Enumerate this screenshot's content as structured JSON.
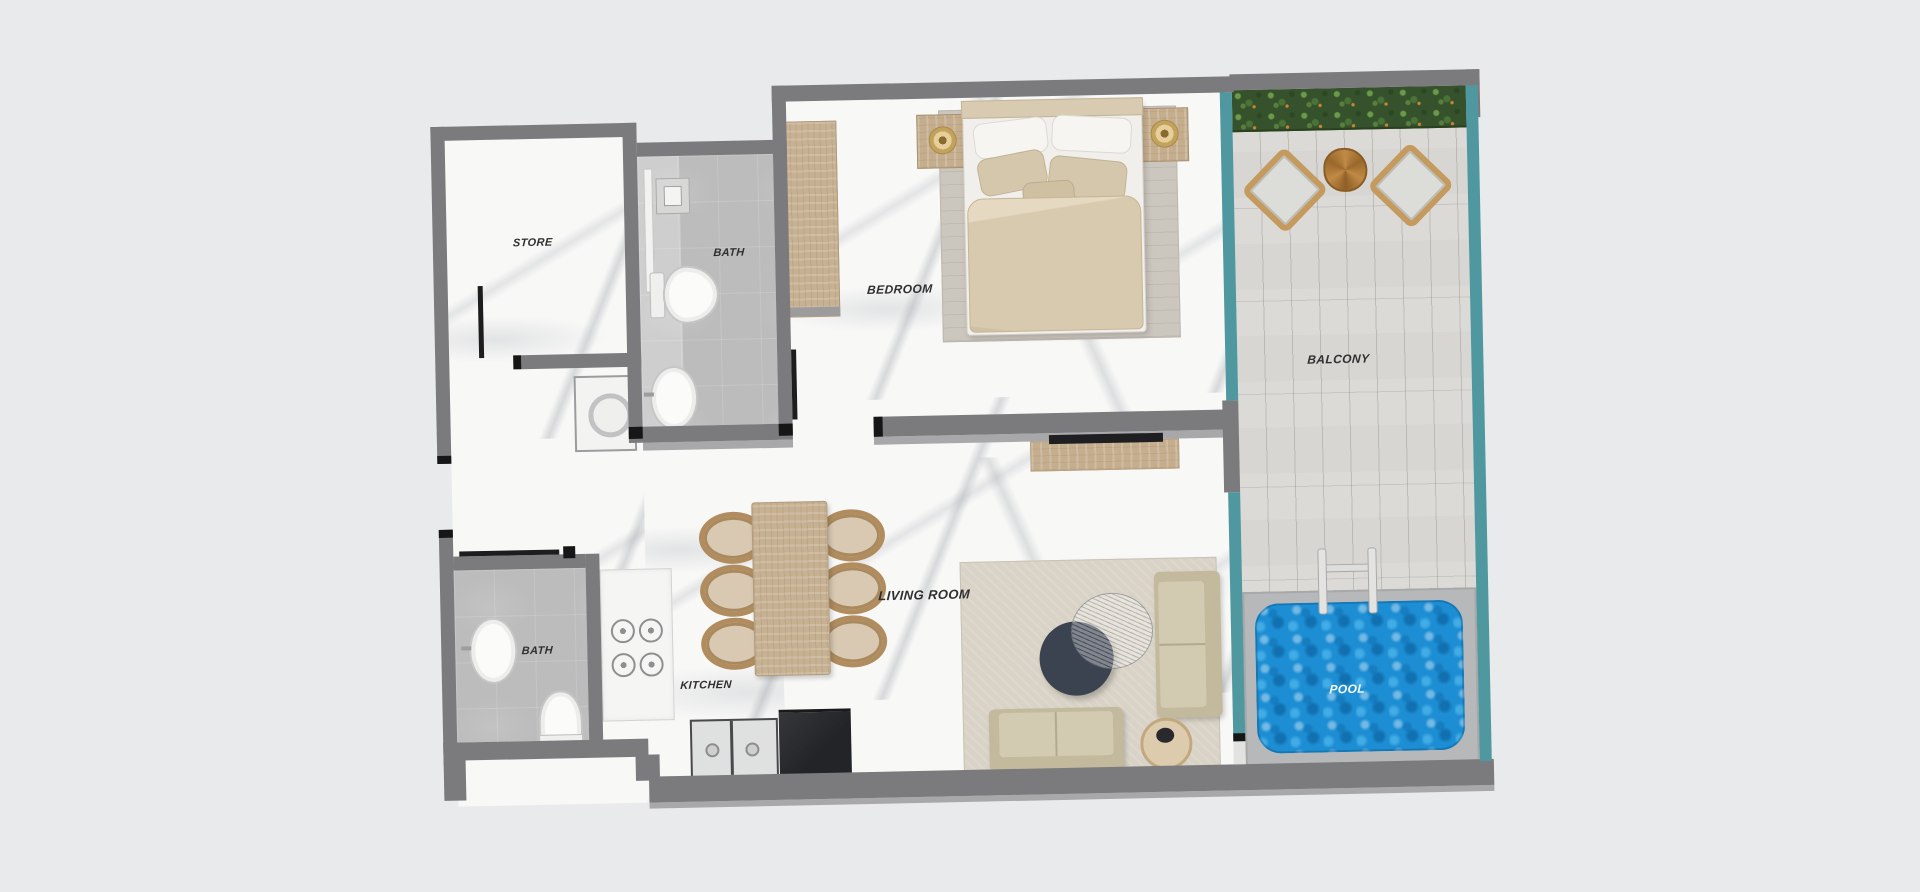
{
  "image_type": "apartment-floor-plan-render",
  "labels": {
    "store": "STORE",
    "bath_top": "BATH",
    "bedroom": "BEDROOM",
    "balcony": "BALCONY",
    "bath_bottom": "BATH",
    "kitchen": "KITCHEN",
    "living_room": "LIVING ROOM",
    "pool": "POOL"
  },
  "colors": {
    "background": "#e9eaeb",
    "wall": "#7b7b7d",
    "glass_railing_teal": "#4f98a0",
    "pool_water_blue": "#1d8ed3",
    "hedge_green": "#35522c",
    "deck_plank": "#d7d6d3",
    "marble_floor": "#f8f8f7",
    "bath_tile": "#bcbcbd",
    "wood_furniture": "#c5ae8e",
    "upholstery_beige": "#d0c8af",
    "coffee_table_dark": "#3b4250"
  }
}
